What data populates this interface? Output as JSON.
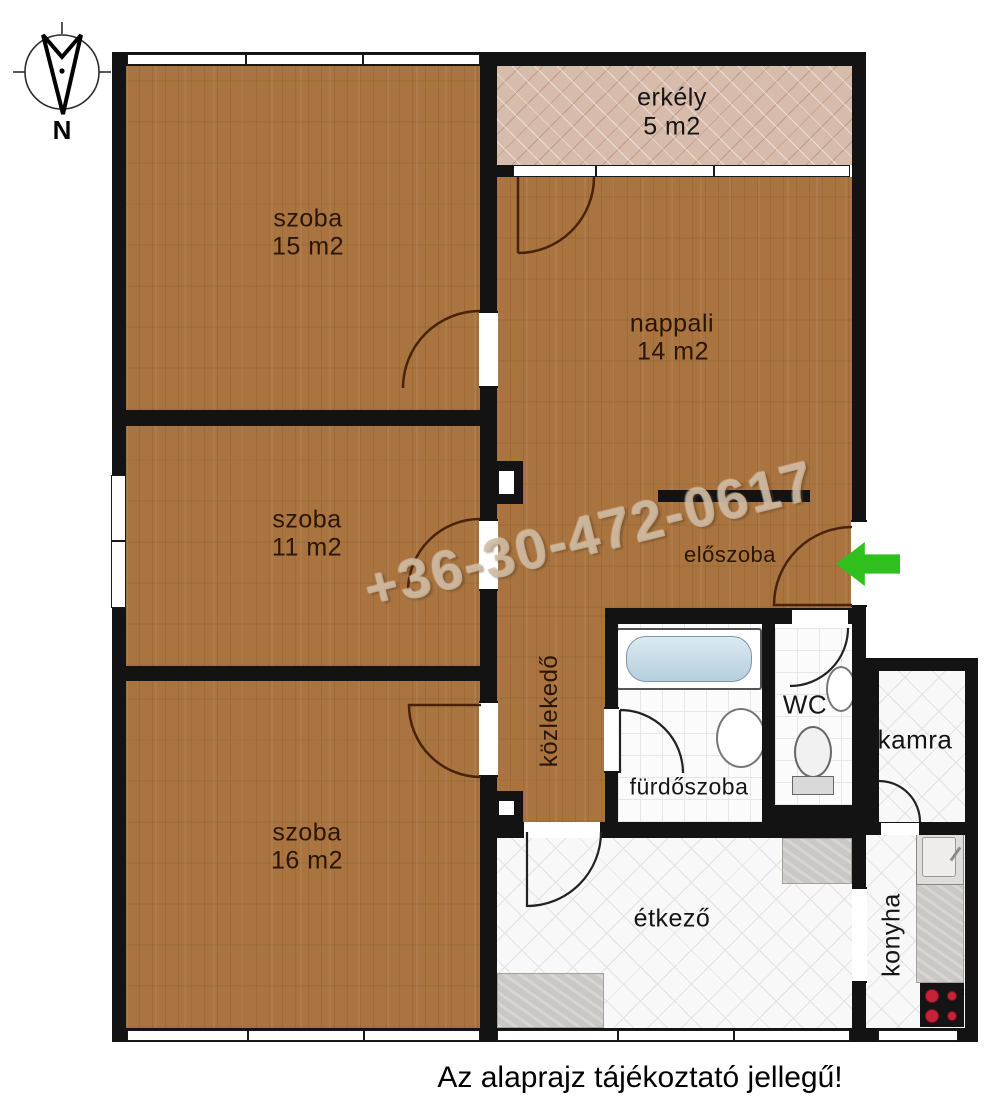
{
  "caption": "Az alaprajz tájékoztató jellegű!",
  "watermark": "+36-30-472-0617",
  "compass": {
    "label": "N"
  },
  "rooms": {
    "szoba15": {
      "name": "szoba",
      "area": "15 m2"
    },
    "szoba11": {
      "name": "szoba",
      "area": "11 m2"
    },
    "szoba16": {
      "name": "szoba",
      "area": "16 m2"
    },
    "nappali": {
      "name": "nappali",
      "area": "14 m2"
    },
    "erkely": {
      "name": "erkély",
      "area": "5 m2"
    },
    "eloszoba": {
      "name": "előszoba"
    },
    "kozlekedo": {
      "name": "közlekedő"
    },
    "furdoszoba": {
      "name": "fürdőszoba"
    },
    "wc": {
      "name": "WC"
    },
    "kamra": {
      "name": "kamra"
    },
    "etkezo": {
      "name": "étkező"
    },
    "konyha": {
      "name": "konyha"
    }
  },
  "colors": {
    "wood": "#a9743f",
    "wall": "#131313",
    "balcony_tile": "#d8bcab",
    "accent_green": "#2fc01e",
    "stove_burner": "#c62238"
  }
}
